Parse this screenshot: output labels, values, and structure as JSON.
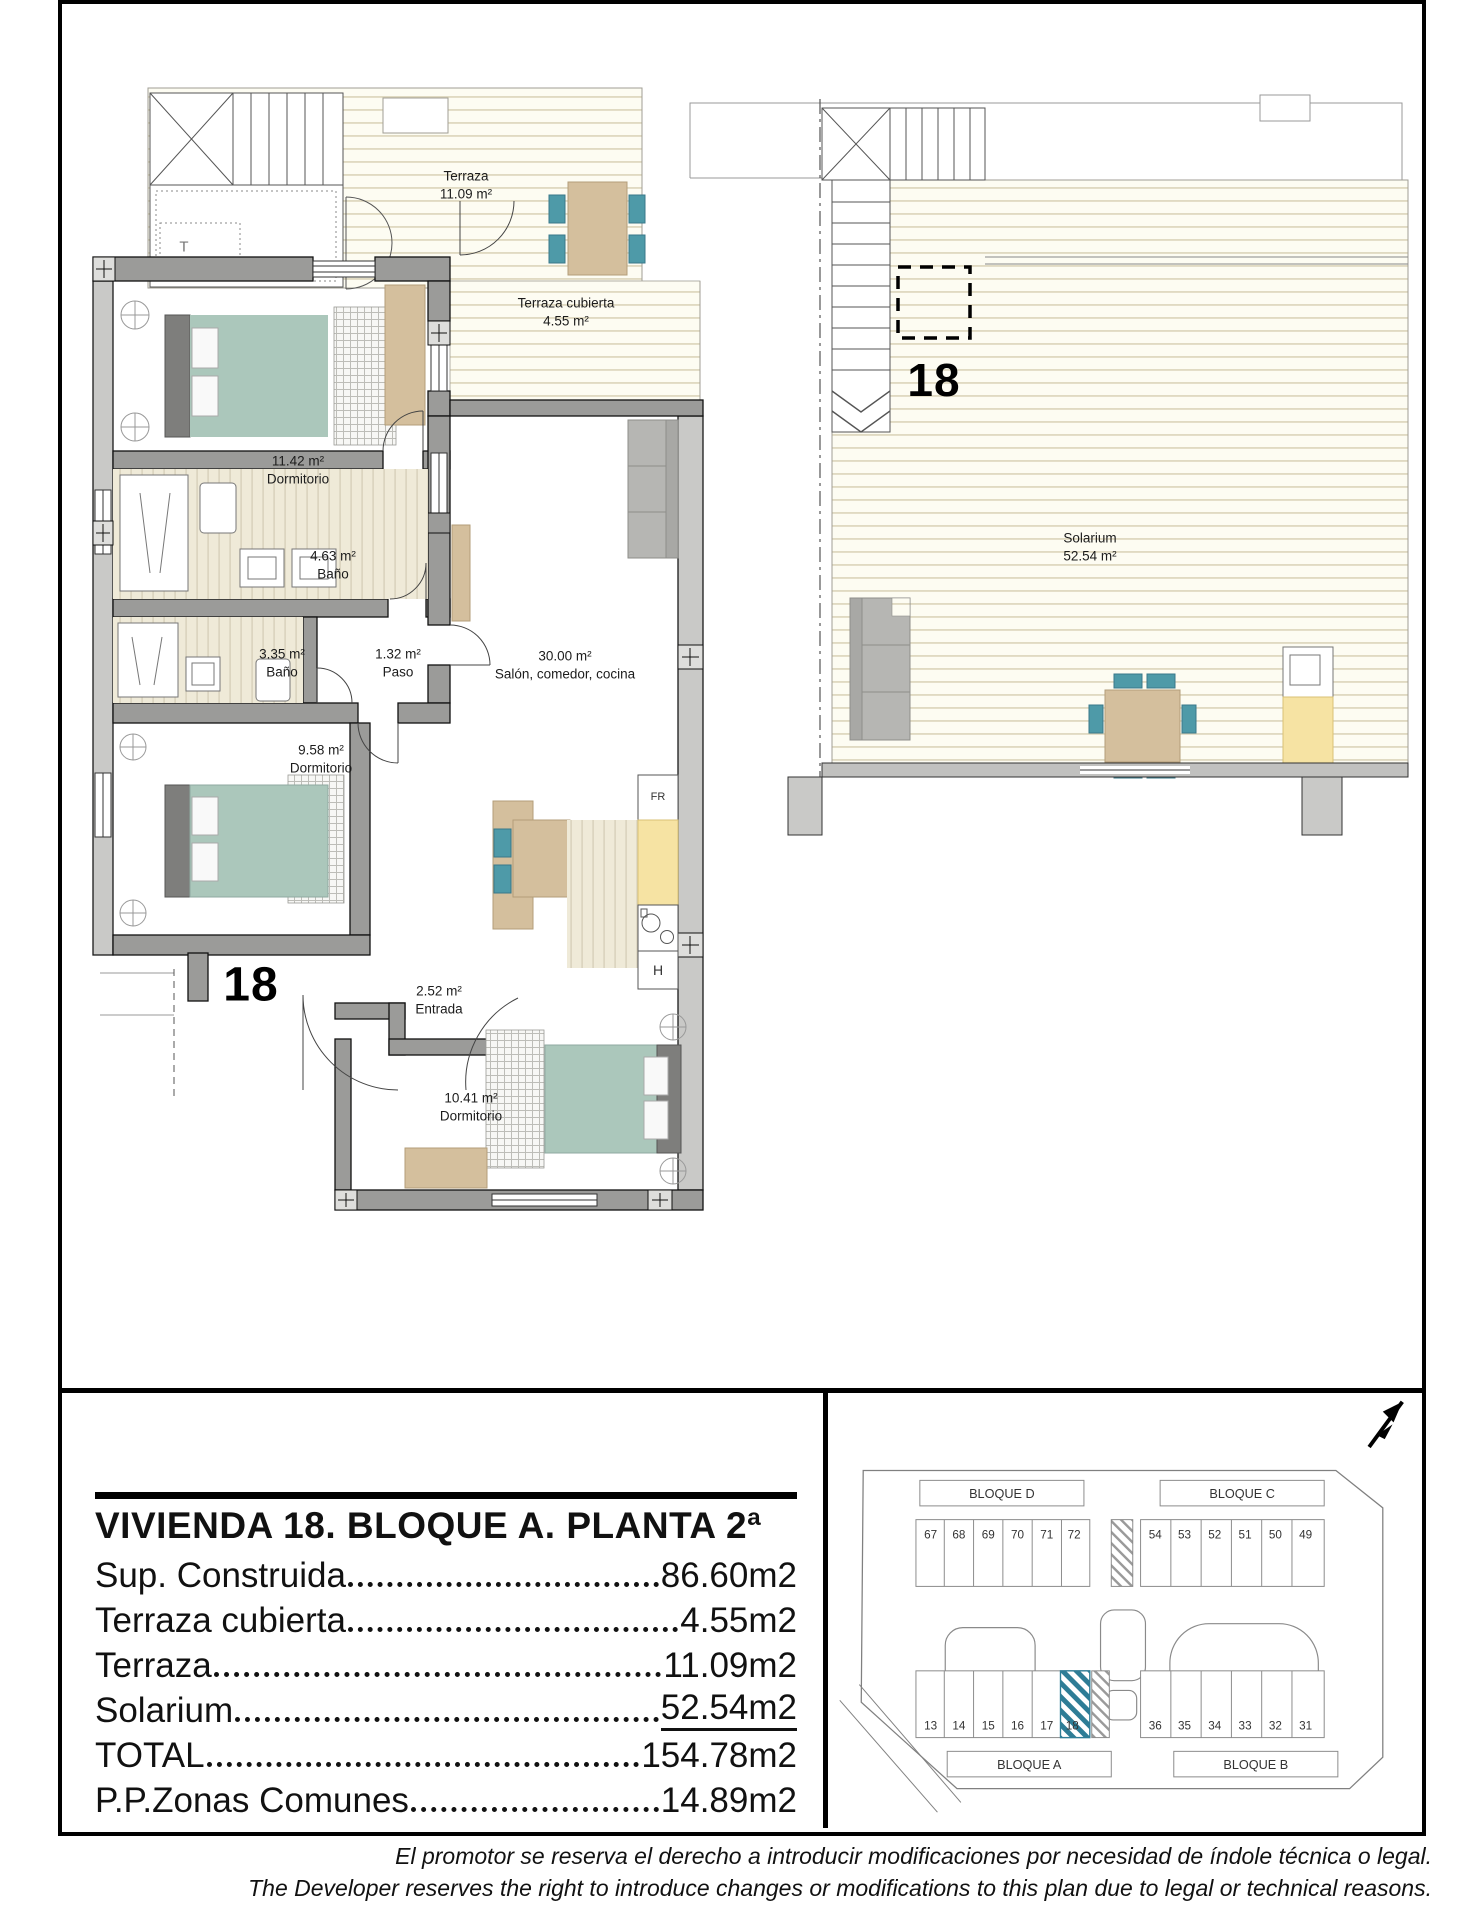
{
  "unit_plan": {
    "unit_label": "18",
    "terrace_marker": "T",
    "rooms": {
      "terraza": {
        "name": "Terraza",
        "area": "11.09 m²"
      },
      "terraza_cubierta": {
        "name": "Terraza cubierta",
        "area": "4.55 m²"
      },
      "dormitorio1": {
        "name": "Dormitorio",
        "area": "11.42 m²"
      },
      "bano1": {
        "name": "Baño",
        "area": "4.63 m²"
      },
      "bano2": {
        "name": "Baño",
        "area": "3.35 m²"
      },
      "paso": {
        "name": "Paso",
        "area": "1.32 m²"
      },
      "salon": {
        "name": "Salón, comedor, cocina",
        "area": "30.00 m²"
      },
      "dormitorio2": {
        "name": "Dormitorio",
        "area": "9.58 m²"
      },
      "entrada": {
        "name": "Entrada",
        "area": "2.52 m²"
      },
      "dormitorio3": {
        "name": "Dormitorio",
        "area": "10.41 m²"
      }
    },
    "appliances": {
      "fridge": "FR",
      "laundry": "H"
    }
  },
  "solarium_plan": {
    "unit_label": "18",
    "room": {
      "name": "Solarium",
      "area": "52.54 m²"
    }
  },
  "summary": {
    "title": "VIVIENDA 18. BLOQUE A. PLANTA 2ª",
    "rows": [
      {
        "label": "Sup. Construida",
        "value": "86.60m2"
      },
      {
        "label": "Terraza cubierta",
        "value": "4.55m2"
      },
      {
        "label": "Terraza",
        "value": "11.09m2"
      },
      {
        "label": "Solarium",
        "value": "52.54m2"
      },
      {
        "label": "TOTAL",
        "value": "154.78m2"
      },
      {
        "label": "P.P.Zonas Comunes",
        "value": "14.89m2"
      }
    ]
  },
  "site_plan": {
    "highlighted_unit": "18",
    "blocks": {
      "d": {
        "name": "BLOQUE D",
        "units": [
          "67",
          "68",
          "69",
          "70",
          "71",
          "72"
        ]
      },
      "c": {
        "name": "BLOQUE C",
        "units": [
          "54",
          "53",
          "52",
          "51",
          "50",
          "49"
        ]
      },
      "a": {
        "name": "BLOQUE A",
        "units": [
          "13",
          "14",
          "15",
          "16",
          "17",
          "18"
        ]
      },
      "b": {
        "name": "BLOQUE B",
        "units": [
          "36",
          "35",
          "34",
          "33",
          "32",
          "31"
        ]
      }
    }
  },
  "disclaimer": {
    "es": "El promotor se reserva el derecho a introducir modificaciones por necesidad de índole técnica o legal.",
    "en": "The Developer reserves the right to introduce changes or modifications to this plan due to legal or technical reasons."
  },
  "colors": {
    "accent_teal": "#4e9aa8",
    "highlight_hatch": "#2e7d96",
    "bed": "#abc7bb",
    "wood": "#d4bf9d",
    "kitchen_yellow": "#f6e3a3"
  }
}
